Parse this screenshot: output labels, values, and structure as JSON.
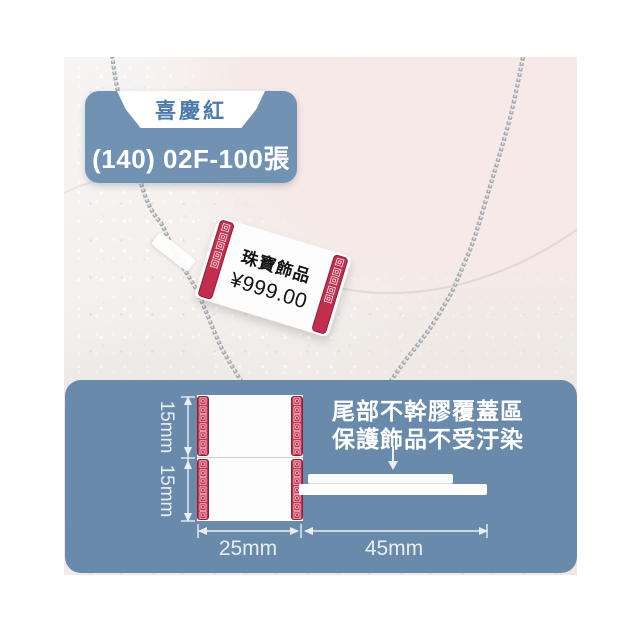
{
  "badge": {
    "tab_label": "喜慶紅",
    "model_label": "(140) 02F-100張"
  },
  "price_tag": {
    "line1": "珠寶飾品",
    "line2": "¥999.00",
    "border_pattern": "回回回回回"
  },
  "panel": {
    "annotation_line1": "尾部不幹膠覆蓋區",
    "annotation_line2": "保護飾品不受汙染",
    "dim_height_top": "15mm",
    "dim_height_bottom": "15mm",
    "dim_width_label": "25mm",
    "dim_width_tail": "45mm",
    "label_border_pattern": "回回回回回回回"
  },
  "colors": {
    "panel_blue": "#6a8aab",
    "badge_blue": "#7292b4",
    "badge_text_blue": "#4c7bab",
    "meander_red": "#c22f4e",
    "annotation_white": "#ffffff",
    "chain_silver": "#a6a9ad"
  }
}
